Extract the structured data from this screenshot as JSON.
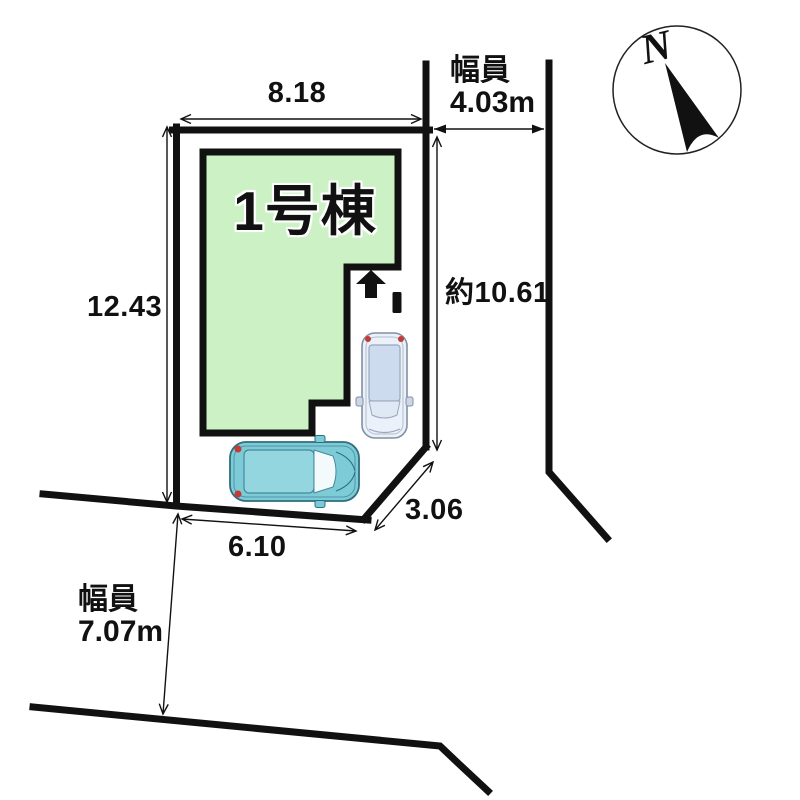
{
  "plan": {
    "compass": {
      "north_label": "N"
    },
    "building": {
      "label": "1号棟",
      "fill": "#cbf1c4"
    },
    "dimensions": {
      "top": "8.18",
      "left": "12.43",
      "right": "約10.61",
      "bottom": "6.10",
      "corner": "3.06"
    },
    "road_right": {
      "title": "幅員",
      "value": "4.03m"
    },
    "road_bottom": {
      "title": "幅員",
      "value": "7.07m"
    },
    "colors": {
      "line": "#111111",
      "building_fill": "#cbf1c4",
      "car_teal_body": "#7ecbd8",
      "car_pale_body": "#ebf1fa",
      "tail_light": "#c43b35"
    }
  }
}
